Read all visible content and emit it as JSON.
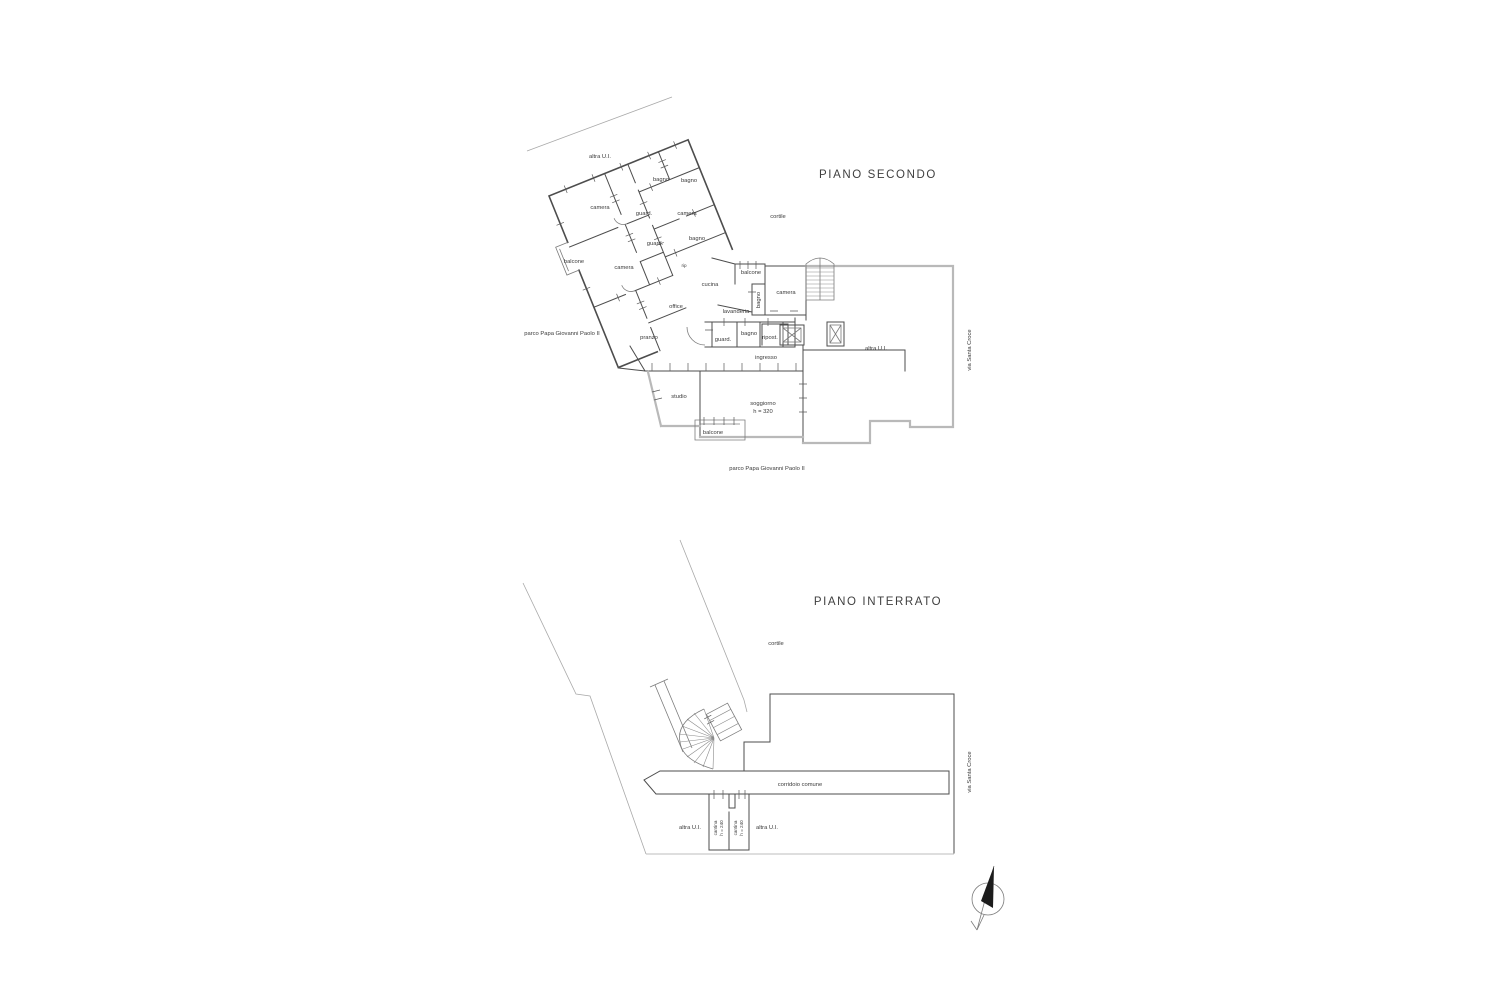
{
  "document": {
    "type": "floor-plan-drawing",
    "background": "#ffffff",
    "line_color_dark": "#4d4d4d",
    "line_color_light": "#b9b9b9",
    "text_color": "#3a3a3a"
  },
  "plans": [
    {
      "id": "piano-secondo",
      "title": "PIANO SECONDO",
      "labels": [
        {
          "text": "PIANO SECONDO",
          "x": 878,
          "y": 178,
          "cls": "title",
          "name": "plan-title-piano-secondo"
        },
        {
          "text": "altra U.I.",
          "x": 600,
          "y": 158,
          "name": "room-label-altra-ui-top"
        },
        {
          "text": "bagno",
          "x": 661,
          "y": 181,
          "name": "room-label-bagno-1"
        },
        {
          "text": "bagno",
          "x": 689,
          "y": 182,
          "name": "room-label-bagno-2"
        },
        {
          "text": "camera",
          "x": 600,
          "y": 209,
          "name": "room-label-camera-1"
        },
        {
          "text": "guard.",
          "x": 644,
          "y": 215,
          "name": "room-label-guard-1"
        },
        {
          "text": "camera",
          "x": 687,
          "y": 215,
          "name": "room-label-camera-2"
        },
        {
          "text": "cortile",
          "x": 778,
          "y": 218,
          "name": "room-label-cortile"
        },
        {
          "text": "bagno",
          "x": 697,
          "y": 240,
          "name": "room-label-bagno-3"
        },
        {
          "text": "guard.",
          "x": 655,
          "y": 245,
          "name": "room-label-guard-2"
        },
        {
          "text": "balcone",
          "x": 574,
          "y": 263,
          "name": "room-label-balcone-1"
        },
        {
          "text": "camera",
          "x": 624,
          "y": 269,
          "name": "room-label-camera-3"
        },
        {
          "text": "rip",
          "x": 684,
          "y": 267,
          "cls": "xs",
          "name": "room-label-rip"
        },
        {
          "text": "balcone",
          "x": 751,
          "y": 274,
          "name": "room-label-balcone-2"
        },
        {
          "text": "cucina",
          "x": 710,
          "y": 286,
          "name": "room-label-cucina"
        },
        {
          "text": "camera",
          "x": 786,
          "y": 294,
          "name": "room-label-camera-4"
        },
        {
          "text": "bagno",
          "x": 760,
          "y": 300,
          "rot": -90,
          "name": "room-label-bagno-4"
        },
        {
          "text": "office",
          "x": 676,
          "y": 308,
          "name": "room-label-office"
        },
        {
          "text": "lavanderia",
          "x": 736,
          "y": 313,
          "name": "room-label-lavanderia"
        },
        {
          "text": "parco Papa Giovanni Paolo II",
          "x": 562,
          "y": 335,
          "name": "site-label-parco-left"
        },
        {
          "text": "pranzo",
          "x": 649,
          "y": 339,
          "name": "room-label-pranzo"
        },
        {
          "text": "guard.",
          "x": 723,
          "y": 341,
          "name": "room-label-guard-3"
        },
        {
          "text": "bagno",
          "x": 749,
          "y": 335,
          "name": "room-label-bagno-5"
        },
        {
          "text": "ripost.",
          "x": 770,
          "y": 339,
          "name": "room-label-ripost"
        },
        {
          "text": "altra U.I.",
          "x": 876,
          "y": 350,
          "name": "room-label-altra-ui-right"
        },
        {
          "text": "ingresso",
          "x": 766,
          "y": 359,
          "name": "room-label-ingresso"
        },
        {
          "text": "studio",
          "x": 679,
          "y": 398,
          "name": "room-label-studio"
        },
        {
          "text": "soggiorno",
          "x": 763,
          "y": 405,
          "name": "room-label-soggiorno"
        },
        {
          "text": "h = 320",
          "x": 763,
          "y": 413,
          "name": "room-label-soggiorno-height"
        },
        {
          "text": "balcone",
          "x": 713,
          "y": 434,
          "name": "room-label-balcone-3"
        },
        {
          "text": "parco Papa Giovanni Paolo II",
          "x": 767,
          "y": 470,
          "name": "site-label-parco-bottom"
        },
        {
          "text": "via Santa Croce",
          "x": 971,
          "y": 350,
          "rot": -90,
          "name": "street-label-via-santa-croce-top"
        }
      ]
    },
    {
      "id": "piano-interrato",
      "title": "PIANO INTERRATO",
      "labels": [
        {
          "text": "PIANO INTERRATO",
          "x": 878,
          "y": 605,
          "cls": "title",
          "name": "plan-title-piano-interrato"
        },
        {
          "text": "cortile",
          "x": 776,
          "y": 645,
          "name": "room-label-cortile-basement"
        },
        {
          "text": "corridoio comune",
          "x": 800,
          "y": 786,
          "name": "room-label-corridoio-comune"
        },
        {
          "text": "altra U.I.",
          "x": 690,
          "y": 829,
          "name": "room-label-altra-ui-basement-left"
        },
        {
          "text": "cantina",
          "x": 717,
          "y": 828,
          "rot": -90,
          "cls": "xs",
          "name": "room-label-cantina-1"
        },
        {
          "text": "h = 240",
          "x": 723,
          "y": 828,
          "rot": -90,
          "cls": "xs",
          "name": "room-label-cantina-1-height"
        },
        {
          "text": "cantina",
          "x": 737,
          "y": 828,
          "rot": -90,
          "cls": "xs",
          "name": "room-label-cantina-2"
        },
        {
          "text": "h = 240",
          "x": 743,
          "y": 828,
          "rot": -90,
          "cls": "xs",
          "name": "room-label-cantina-2-height"
        },
        {
          "text": "altra U.I.",
          "x": 767,
          "y": 829,
          "name": "room-label-altra-ui-basement-right"
        },
        {
          "text": "via Santa Croce",
          "x": 971,
          "y": 772,
          "rot": -90,
          "name": "street-label-via-santa-croce-bottom"
        }
      ]
    }
  ],
  "compass": {
    "type": "north-arrow"
  }
}
